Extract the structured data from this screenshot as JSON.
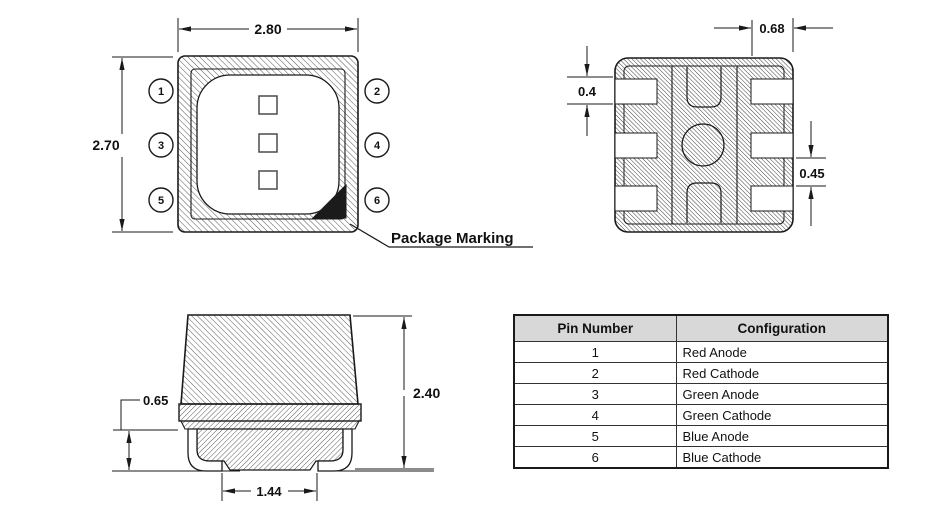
{
  "top_view": {
    "width_dim": "2.80",
    "height_dim": "2.70",
    "marking_label": "Package Marking",
    "pin_labels": [
      "1",
      "2",
      "3",
      "4",
      "5",
      "6"
    ]
  },
  "bottom_view": {
    "pad_length_dim": "0.68",
    "pad_height_dim": "0.4",
    "pad_gap_dim": "0.45"
  },
  "side_view": {
    "standoff_dim": "0.65",
    "height_dim": "2.40",
    "lead_span_dim": "1.44"
  },
  "pin_table": {
    "headers": [
      "Pin Number",
      "Configuration"
    ],
    "rows": [
      {
        "pin": "1",
        "config": "Red Anode"
      },
      {
        "pin": "2",
        "config": "Red Cathode"
      },
      {
        "pin": "3",
        "config": "Green Anode"
      },
      {
        "pin": "4",
        "config": "Green Cathode"
      },
      {
        "pin": "5",
        "config": "Blue Anode"
      },
      {
        "pin": "6",
        "config": "Blue Cathode"
      }
    ]
  },
  "colors": {
    "line": "#1a1a1a",
    "marking_fill": "#1b1b1b",
    "table_header_bg": "#d8d8d8"
  }
}
